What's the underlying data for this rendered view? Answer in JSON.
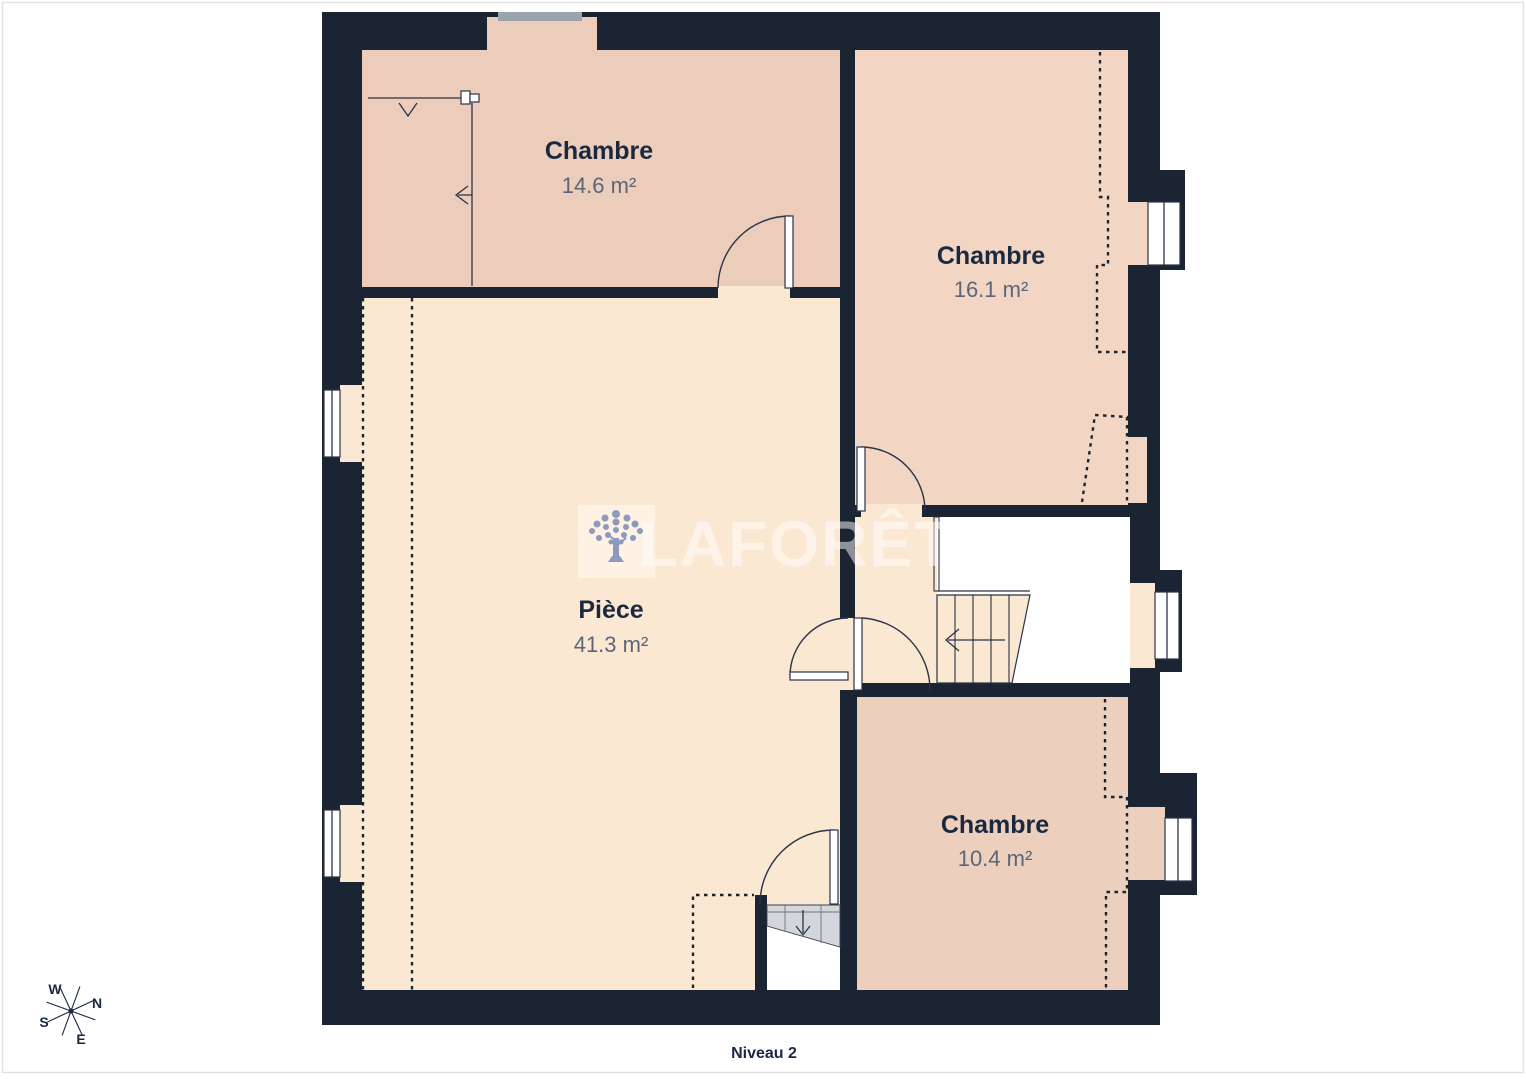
{
  "plan": {
    "level_label": "Niveau 2",
    "brand": "LAFORÊT",
    "rooms": [
      {
        "name": "Chambre",
        "area": "14.6 m²"
      },
      {
        "name": "Chambre",
        "area": "16.1 m²"
      },
      {
        "name": "Pièce",
        "area": "41.3 m²"
      },
      {
        "name": "Chambre",
        "area": "10.4 m²"
      }
    ],
    "compass": {
      "west": "W",
      "north": "N",
      "south": "S",
      "east": "E"
    },
    "colors": {
      "wall": "#1b2433",
      "room_pink_1": "#ecccba",
      "room_pink_2": "#f2d6c3",
      "room_pink_3": "#edcfbd",
      "room_cream": "#fbe8d3",
      "stair_gray": "#d3d6da",
      "dormer_gray": "#9ba3ad",
      "label_name": "#1b2940",
      "label_area": "#5b6678",
      "logo_tree": "#8d99bd",
      "logo_box": "#fdf2e4"
    }
  }
}
